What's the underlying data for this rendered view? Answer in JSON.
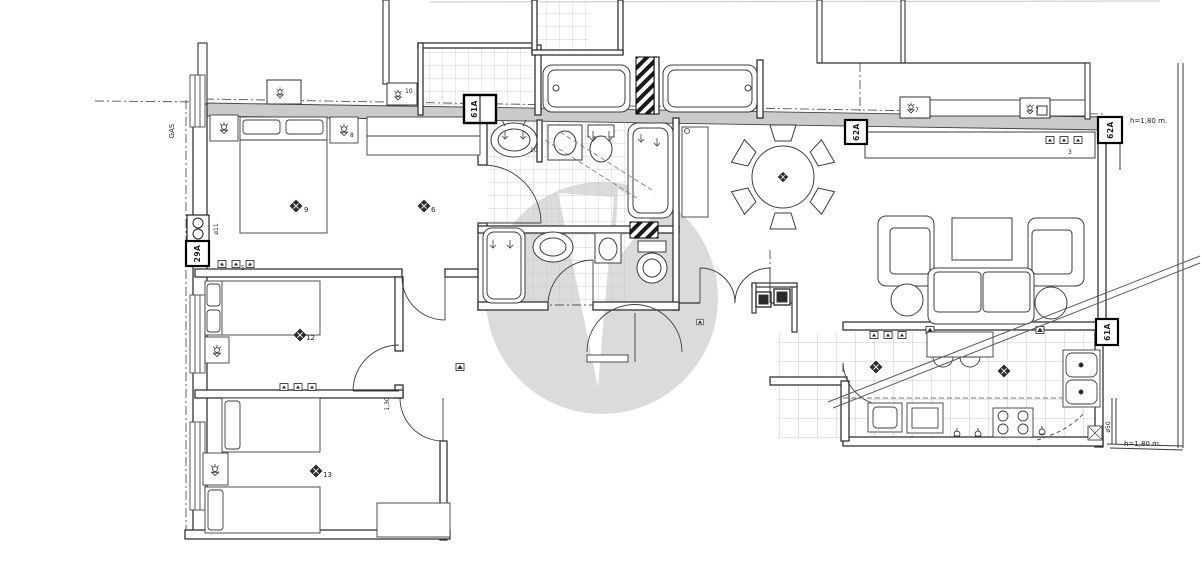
{
  "document": {
    "type": "scanned architectural floor plan, apartment",
    "background": "#ffffff"
  },
  "colors": {
    "line": "#3a3a3a",
    "wall_fill": "#cbcbcb",
    "tile_line": "#c4c4c4",
    "watermark": "#dadcdc",
    "hatch": "#1a1a1a"
  },
  "labels": {
    "gas": "GAS",
    "height_note_top": "h=1,80 m.",
    "height_note_bottom": "h=1,80 m.",
    "wall_box_bath": "61A",
    "wall_box_dining": "62A",
    "wall_box_terrace": "62A",
    "wall_box_kitchen": "61A",
    "meter_box": "29A",
    "diameter_note_meter": "ø11",
    "diameter_note_kitchen": "ø50",
    "door_width_note": "1,30",
    "light_bedroom1": "9",
    "light_bedroom1_b": "6",
    "light_bedroom2": "12",
    "light_bedroom3": "13",
    "nightstand_note": "8",
    "basin_note": "10",
    "wall_lamp_note": "10",
    "switch_note": "5",
    "tv_note": "3",
    "lamp_note_a": "7",
    "lamp_note_b": "7"
  }
}
